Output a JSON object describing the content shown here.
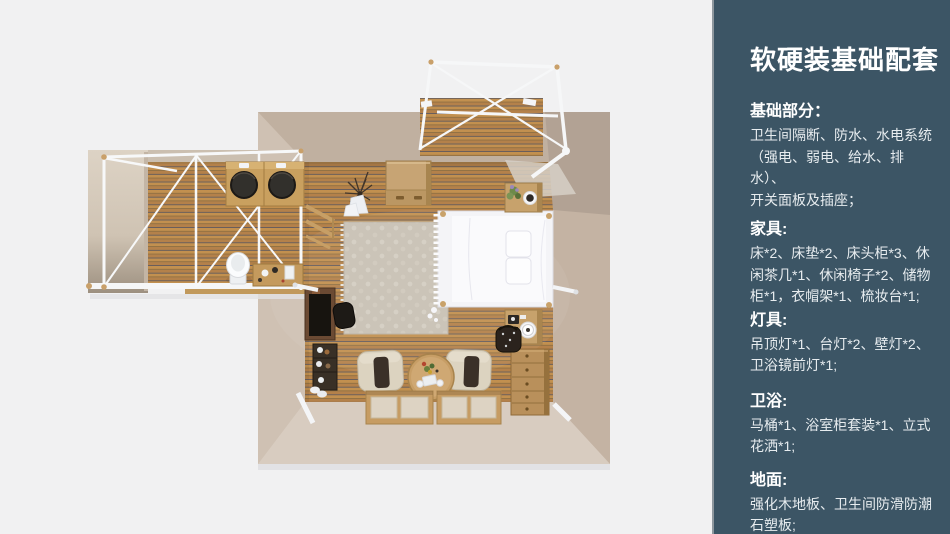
{
  "colors": {
    "background": "#f1f1f2",
    "panel_bg": "#3c5565",
    "panel_border": "#8e979e",
    "panel_title": "#ffffff",
    "panel_body": "#e7ecef",
    "wood_slat": "#c2904f",
    "wood_slat_dark": "#b4814a",
    "wood_groove": "#575560",
    "wall_tan": "#cbbcad",
    "wall_shadow": "#b2a294",
    "wall_light": "#d8ccc0",
    "frame_white": "#f6f7f8",
    "furniture_wood": "#c9a26a"
  },
  "floor_plan": {
    "view": "top-down-3d-room-render",
    "areas": [
      "bedroom",
      "bathroom-annex",
      "deck-pergola"
    ],
    "items": [
      "double-bed",
      "pillows",
      "rug",
      "storage-cabinet",
      "nightstand",
      "nightstand",
      "plant",
      "coat-rack",
      "desk",
      "desk-chair",
      "shoe-shelf",
      "armchair",
      "armchair",
      "round-tea-table",
      "floor-mats",
      "dresser",
      "laundry-basket",
      "twin-sinks",
      "toilet",
      "vanity-items",
      "wall-lamp",
      "wall-lamp"
    ]
  },
  "panel": {
    "title": "软硬装基础配套",
    "sections": [
      {
        "heading": "基础部分：",
        "body": "卫生间隔断、防水、水电系统\n（强电、弱电、给水、排水）、\n开关面板及插座；"
      },
      {
        "heading": "家具:",
        "body": "床*2、床垫*2、床头柜*3、休\n闲茶几*1、休闲椅子*2、储物\n柜*1，衣帽架*1、梳妆台*1;"
      },
      {
        "heading": "灯具:",
        "body": "吊顶灯*1、台灯*2、壁灯*2、\n卫浴镜前灯*1;"
      },
      {
        "heading": "卫浴:",
        "body": "马桶*1、浴室柜套装*1、立式\n花洒*1;"
      },
      {
        "heading": "地面:",
        "body": "强化木地板、卫生间防滑防潮\n石塑板;"
      }
    ]
  }
}
